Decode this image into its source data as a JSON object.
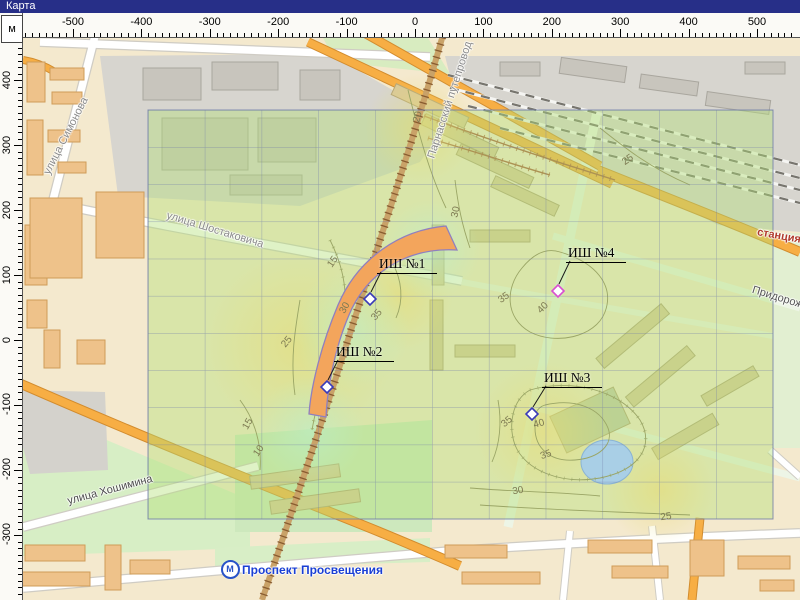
{
  "window": {
    "title": "Карта"
  },
  "rulers": {
    "unit": "м",
    "top": {
      "origin_px": 415,
      "px_per_100m": 68.4,
      "labels": [
        -500,
        -400,
        -300,
        -200,
        -100,
        0,
        100,
        200,
        300,
        400,
        500
      ]
    },
    "left": {
      "origin_px": 340,
      "px_per_100m": 65,
      "labels": [
        400,
        300,
        200,
        100,
        0,
        -100,
        -200,
        -300
      ]
    }
  },
  "map": {
    "survey_points": [
      {
        "id": "point-1",
        "label": "ИШ №1",
        "x": 370,
        "y": 299,
        "label_x": 377,
        "label_y": 256,
        "color": "#3a3ab8"
      },
      {
        "id": "point-2",
        "label": "ИШ №2",
        "x": 327,
        "y": 387,
        "label_x": 334,
        "label_y": 344,
        "color": "#3a3ab8"
      },
      {
        "id": "point-3",
        "label": "ИШ №3",
        "x": 532,
        "y": 414,
        "label_x": 542,
        "label_y": 370,
        "color": "#3a3ab8"
      },
      {
        "id": "point-4",
        "label": "ИШ №4",
        "x": 558,
        "y": 291,
        "label_x": 566,
        "label_y": 245,
        "color": "#d94fd0"
      }
    ],
    "street_labels": [
      {
        "text": "улица Симонова",
        "x": 66,
        "y": 136,
        "rot": -63,
        "color": "#8a8a8a",
        "bold": false
      },
      {
        "text": "улица Шостаковича",
        "x": 215,
        "y": 230,
        "rot": 17,
        "color": "#8a8a8a",
        "bold": false
      },
      {
        "text": "улица Хошимина",
        "x": 110,
        "y": 490,
        "rot": -15,
        "color": "#4b4b4b",
        "bold": false
      },
      {
        "text": "Парнасский путепровод",
        "x": 450,
        "y": 100,
        "rot": -72,
        "color": "#8a8a8a",
        "bold": false
      },
      {
        "text": "станция",
        "x": 779,
        "y": 236,
        "rot": 10,
        "color": "#b03a2c",
        "bold": true
      },
      {
        "text": "Придорожная",
        "x": 786,
        "y": 300,
        "rot": 17,
        "color": "#555555",
        "bold": false
      }
    ],
    "metro": {
      "name": "Проспект Просвещения",
      "icon_letter": "М",
      "x": 230,
      "y": 569,
      "color": "#2853c8"
    },
    "contour_labels": [
      {
        "text": "20",
        "x": 418,
        "y": 117,
        "rot": -75
      },
      {
        "text": "25",
        "x": 628,
        "y": 160,
        "rot": -35
      },
      {
        "text": "30",
        "x": 456,
        "y": 212,
        "rot": -78
      },
      {
        "text": "15",
        "x": 333,
        "y": 262,
        "rot": -55
      },
      {
        "text": "35",
        "x": 504,
        "y": 298,
        "rot": -35
      },
      {
        "text": "40",
        "x": 543,
        "y": 308,
        "rot": -45
      },
      {
        "text": "30",
        "x": 345,
        "y": 308,
        "rot": -60
      },
      {
        "text": "35",
        "x": 377,
        "y": 315,
        "rot": -50
      },
      {
        "text": "25",
        "x": 287,
        "y": 342,
        "rot": -50
      },
      {
        "text": "35",
        "x": 507,
        "y": 422,
        "rot": -40
      },
      {
        "text": "40",
        "x": 539,
        "y": 424,
        "rot": -15
      },
      {
        "text": "15",
        "x": 248,
        "y": 424,
        "rot": -60
      },
      {
        "text": "10",
        "x": 259,
        "y": 451,
        "rot": -55
      },
      {
        "text": "35",
        "x": 546,
        "y": 455,
        "rot": -20
      },
      {
        "text": "30",
        "x": 518,
        "y": 491,
        "rot": -10
      },
      {
        "text": "25",
        "x": 666,
        "y": 517,
        "rot": -8
      }
    ],
    "colors": {
      "titlebar": "#272f88",
      "overlay_green": "rgba(178,224,118,0.42)",
      "grid_line": "rgba(110,122,168,0.6)",
      "arc_fill": "#f3a55c",
      "arc_outline": "#8f7fc0",
      "road_orange": "#f7ae44",
      "marker_blue": "#3a3ab8",
      "marker_magenta": "#d94fd0",
      "metro_blue": "#2853c8",
      "pond_blue": "#a9cfe6",
      "station_text": "#b03a2c"
    }
  }
}
